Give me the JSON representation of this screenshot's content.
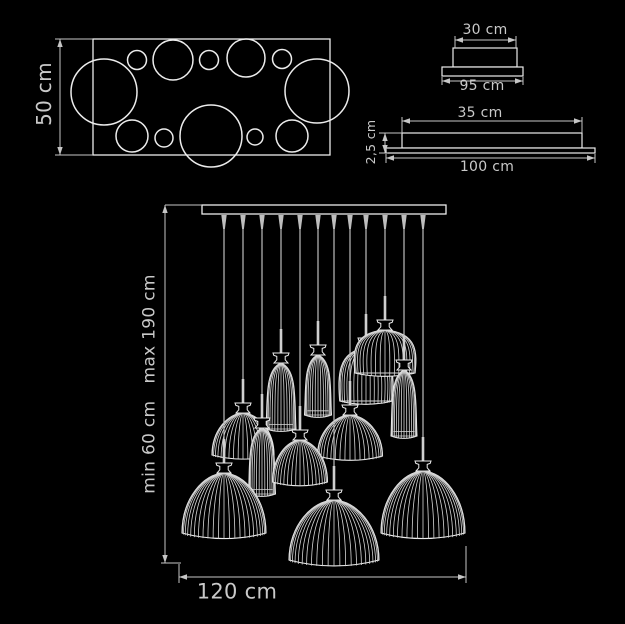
{
  "colors": {
    "background": "#000000",
    "line": "#ececec",
    "rib": "#d6d6d6",
    "cord": "#bdbdbd",
    "rod": "#cfcfcf",
    "dim": "#c6c6c6",
    "text": "#c9c9c9"
  },
  "labels": {
    "top_view_height": "50 cm",
    "canopy_width": "30 cm",
    "canopy_base_width": "95 cm",
    "profile_width": "35 cm",
    "profile_height": "2,5 cm",
    "profile_base_width": "100 cm",
    "drop_range": "min 60 cm   max 190 cm",
    "fixture_width": "120 cm"
  },
  "top_view": {
    "rect": [
      93,
      39,
      237,
      116
    ],
    "dim_x": 60,
    "ext_x": 55,
    "circles": [
      [
        104,
        92,
        33
      ],
      [
        137,
        60,
        9.5
      ],
      [
        173,
        60,
        20
      ],
      [
        209,
        60,
        9.5
      ],
      [
        246,
        58,
        19
      ],
      [
        282,
        59,
        9.5
      ],
      [
        317,
        91,
        32
      ],
      [
        132,
        136,
        16
      ],
      [
        164,
        138,
        9
      ],
      [
        211,
        136,
        31
      ],
      [
        255,
        137,
        8
      ],
      [
        292,
        136,
        16
      ]
    ]
  },
  "canopy_view": {
    "box": [
      453,
      48,
      64,
      19
    ],
    "plate": [
      442,
      67,
      81,
      9
    ],
    "dim_top": {
      "y": 40,
      "x1": 455,
      "x2": 516
    },
    "dim_bottom": {
      "y": 81,
      "x1": 442,
      "x2": 523
    }
  },
  "profile_view": {
    "box": [
      402,
      133,
      180,
      15
    ],
    "plate": [
      386,
      148,
      209,
      5
    ],
    "dim_top": {
      "y": 121,
      "x1": 402,
      "x2": 582
    },
    "dim_left": {
      "x": 385,
      "y1": 133,
      "y2": 153
    },
    "dim_bottom": {
      "y": 158,
      "x1": 386,
      "x2": 595
    }
  },
  "front_view": {
    "bar": [
      202,
      205,
      244,
      9
    ],
    "dim_left": {
      "x": 165,
      "y1": 205,
      "y2": 563
    },
    "dim_bottom": {
      "y": 577,
      "x1": 179,
      "x2": 466
    },
    "pendants": [
      {
        "type": "tulip",
        "x": 318,
        "neck_y": 345,
        "width": 27,
        "height": 60
      },
      {
        "type": "bell",
        "x": 366,
        "neck_y": 338,
        "width": 56,
        "height": 53
      },
      {
        "type": "bell",
        "x": 385,
        "neck_y": 320,
        "width": 64,
        "height": 43
      },
      {
        "type": "tulip",
        "x": 281,
        "neck_y": 353,
        "width": 30,
        "height": 66
      },
      {
        "type": "tulip",
        "x": 404,
        "neck_y": 360,
        "width": 26,
        "height": 66
      },
      {
        "type": "dome_med",
        "x": 243,
        "neck_y": 403,
        "width": 62,
        "height": 42
      },
      {
        "type": "tulip",
        "x": 262,
        "neck_y": 418,
        "width": 27,
        "height": 66
      },
      {
        "type": "dome_med",
        "x": 350,
        "neck_y": 405,
        "width": 65,
        "height": 41
      },
      {
        "type": "dome_med",
        "x": 300,
        "neck_y": 430,
        "width": 55,
        "height": 42
      },
      {
        "type": "dome_large",
        "x": 224,
        "neck_y": 463,
        "width": 84,
        "height": 60
      },
      {
        "type": "dome_large",
        "x": 423,
        "neck_y": 461,
        "width": 84,
        "height": 62
      },
      {
        "type": "dome_large",
        "x": 334,
        "neck_y": 490,
        "width": 90,
        "height": 60
      }
    ]
  }
}
